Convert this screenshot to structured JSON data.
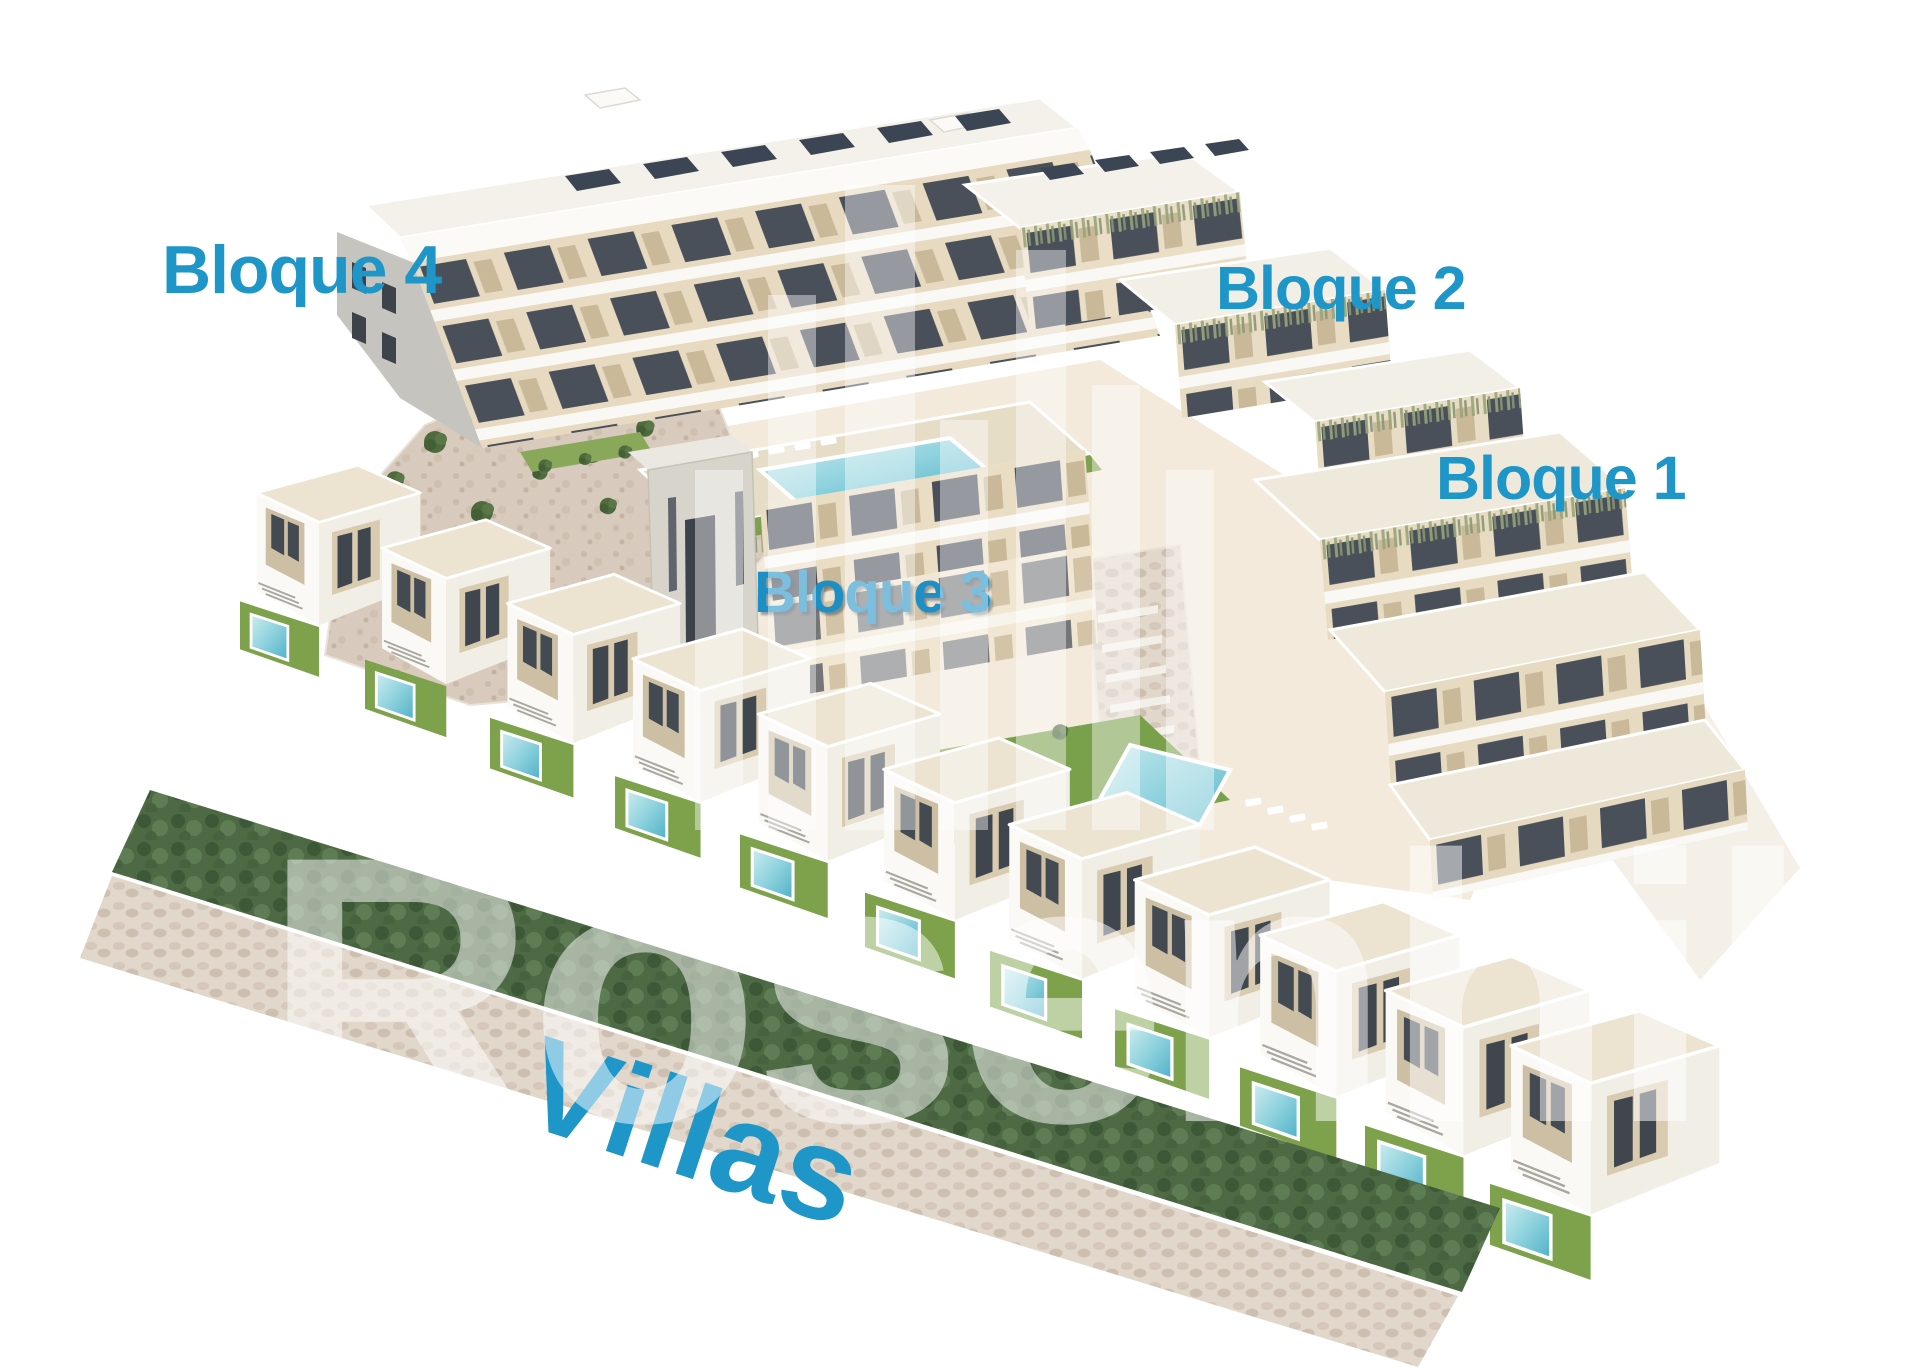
{
  "scene": {
    "title": "Aerial 3D render of residential development with apartment blocks and villas",
    "labels": {
      "bloque4": "Bloque 4",
      "bloque2": "Bloque 2",
      "bloque1": "Bloque 1",
      "bloque3": "Bloque 3",
      "villas": "Villas"
    },
    "watermark": {
      "text": "Rosenhil"
    },
    "colors": {
      "label_blue": "#1e96c8",
      "facade_beige": "#e7dac1",
      "wall_white": "#f7f5ef",
      "roof_cream": "#efe9db",
      "pool_cyan": "#8ed2dd",
      "pool_deep": "#4fb0c8",
      "grass_green": "#7da24b",
      "hedge_green": "#4e6a44",
      "stone_path": "#e2d7cb",
      "rock_terrain": "#d8cabc",
      "solar_panel": "#3b4553",
      "window_dark": "#4a505a",
      "watermark_white": "rgba(255,255,255,0.5)"
    }
  }
}
